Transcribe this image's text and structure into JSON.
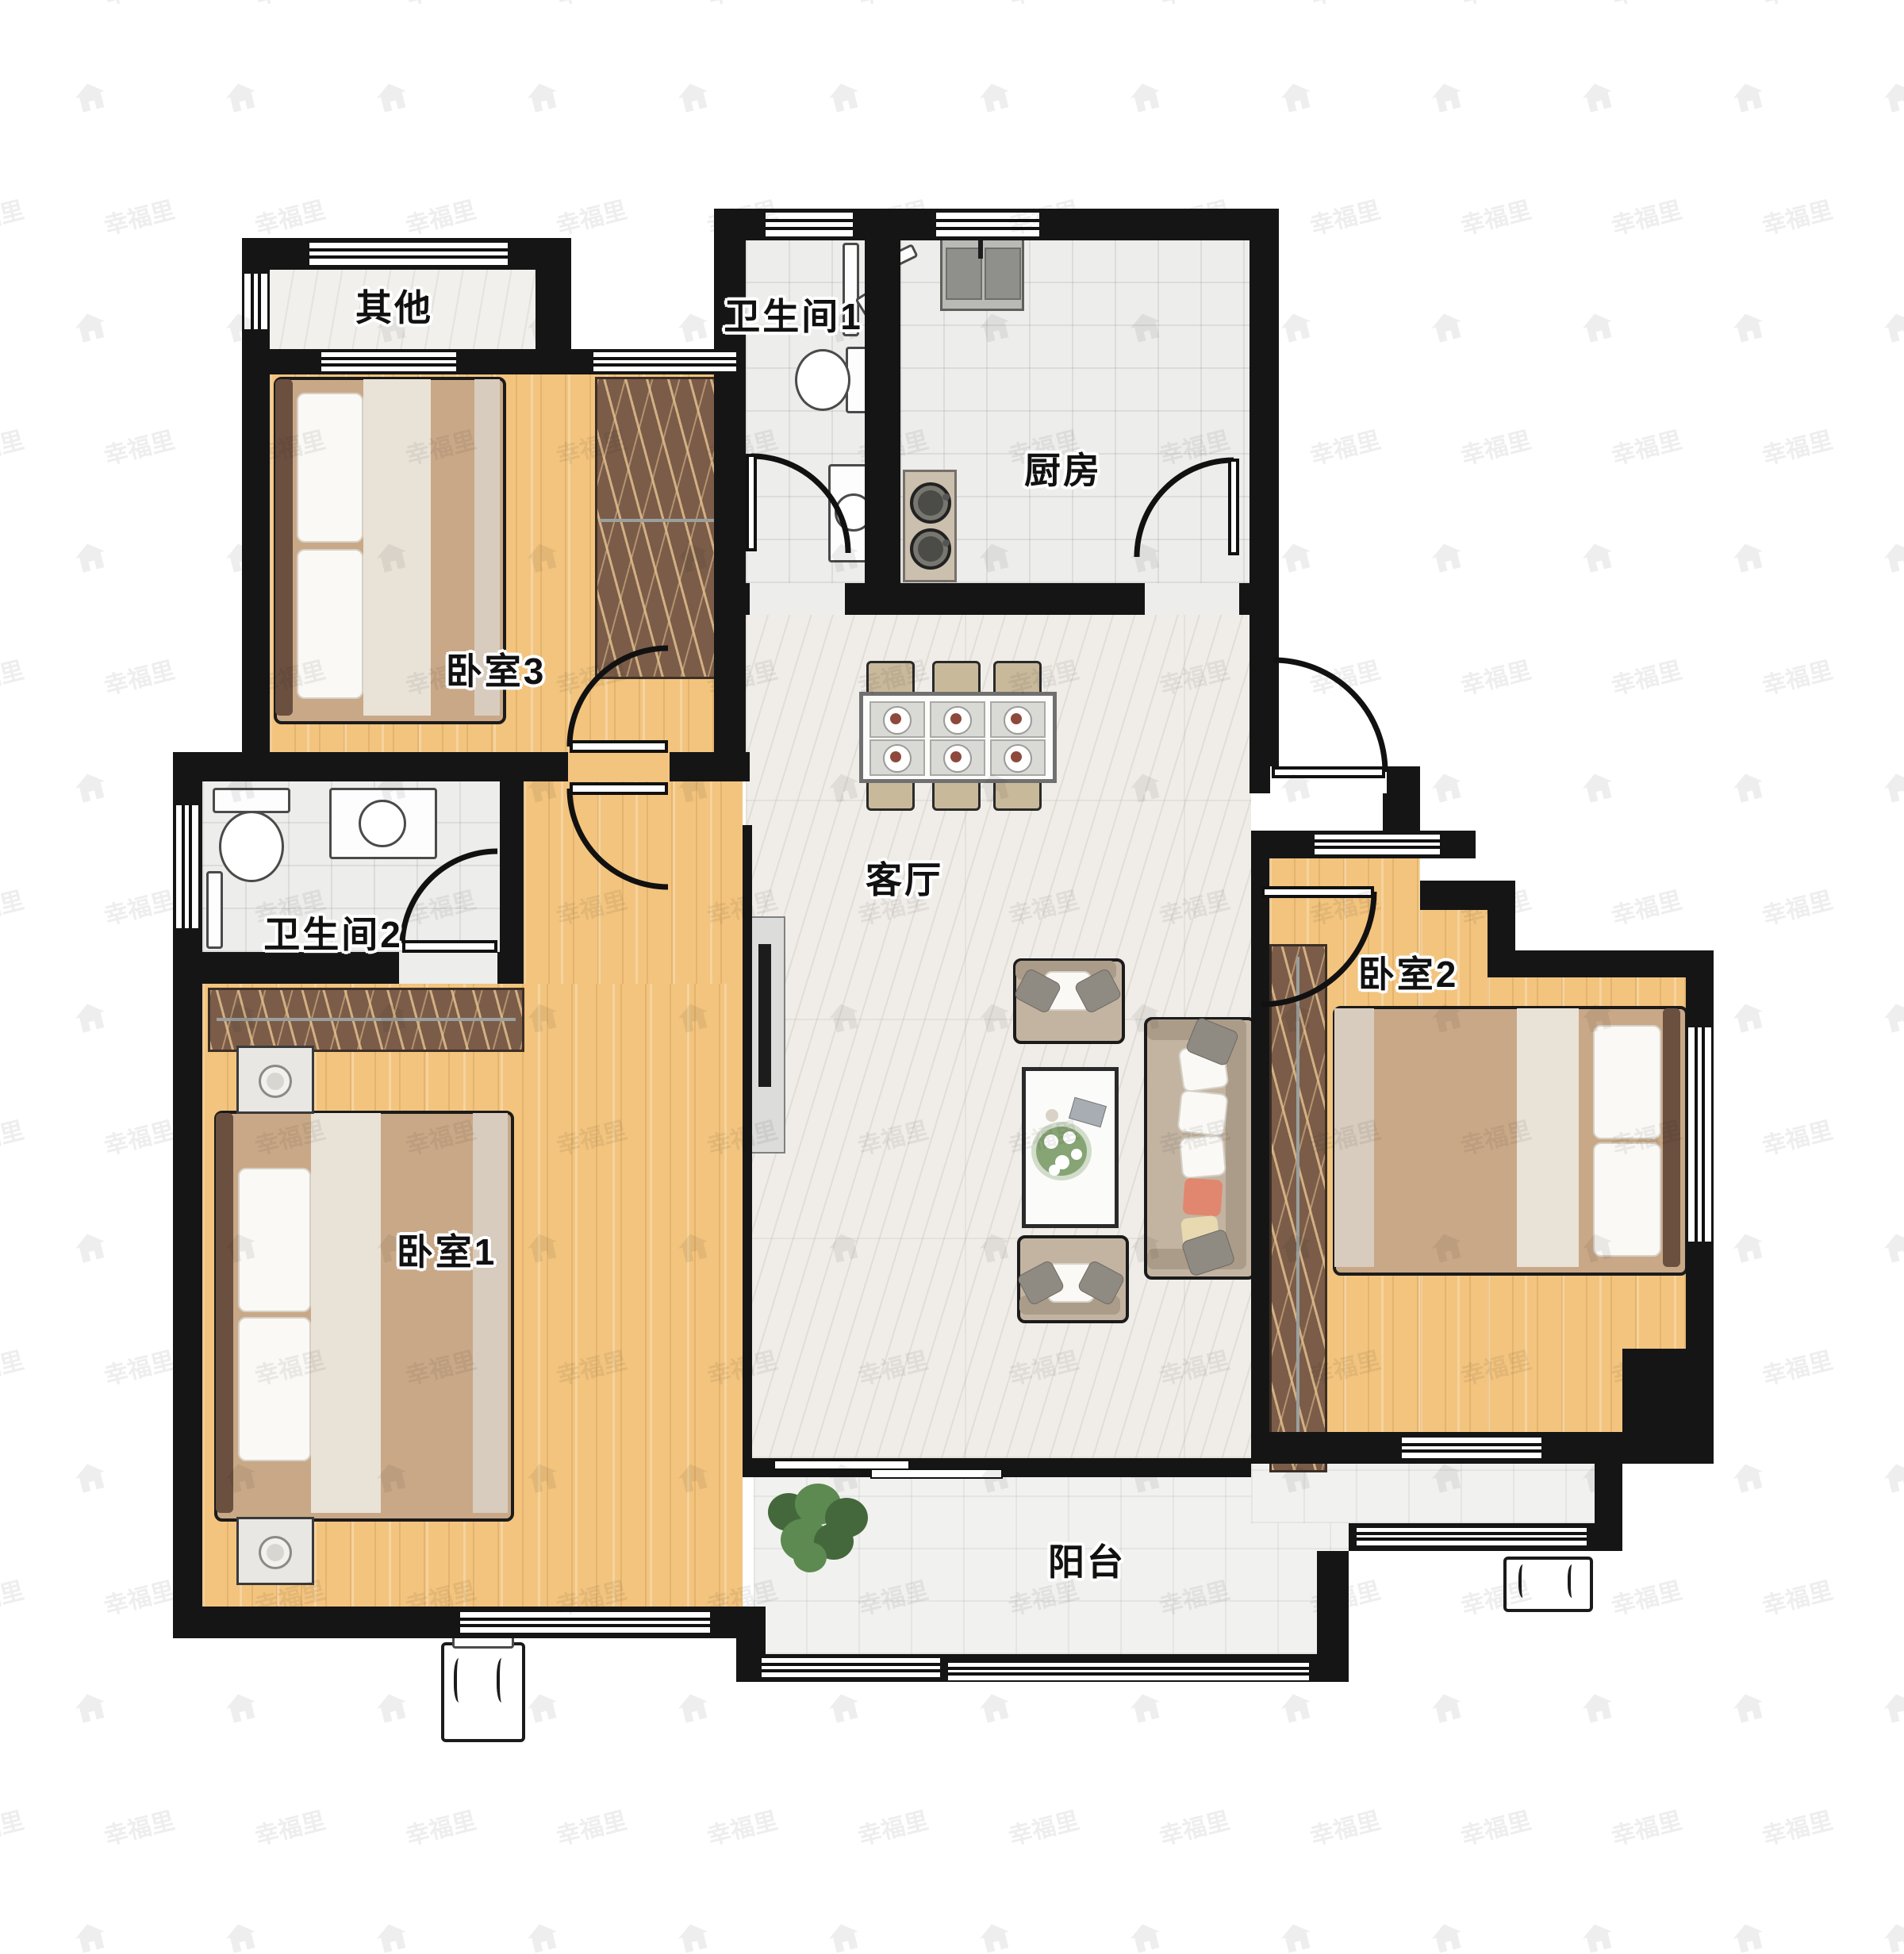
{
  "title": "三室两卫户型图",
  "watermark": {
    "text": "幸福里",
    "icon": "house-icon"
  },
  "rooms": [
    {
      "id": "qita",
      "label": "其他"
    },
    {
      "id": "bedroom3",
      "label": "卧室3"
    },
    {
      "id": "bathroom1",
      "label": "卫生间1"
    },
    {
      "id": "kitchen",
      "label": "厨房"
    },
    {
      "id": "living",
      "label": "客厅"
    },
    {
      "id": "bathroom2",
      "label": "卫生间2"
    },
    {
      "id": "bedroom1",
      "label": "卧室1"
    },
    {
      "id": "bedroom2",
      "label": "卧室2"
    },
    {
      "id": "balcony",
      "label": "阳台"
    }
  ],
  "colors": {
    "wall": "#151515",
    "wood_floor": "#f3c47e",
    "marble_floor": "#f0ede8",
    "tile_floor": "#ededeb",
    "wardrobe": "#7b5c49",
    "sofa": "#c3b4a2",
    "accent_pillow": "#e2876f"
  }
}
